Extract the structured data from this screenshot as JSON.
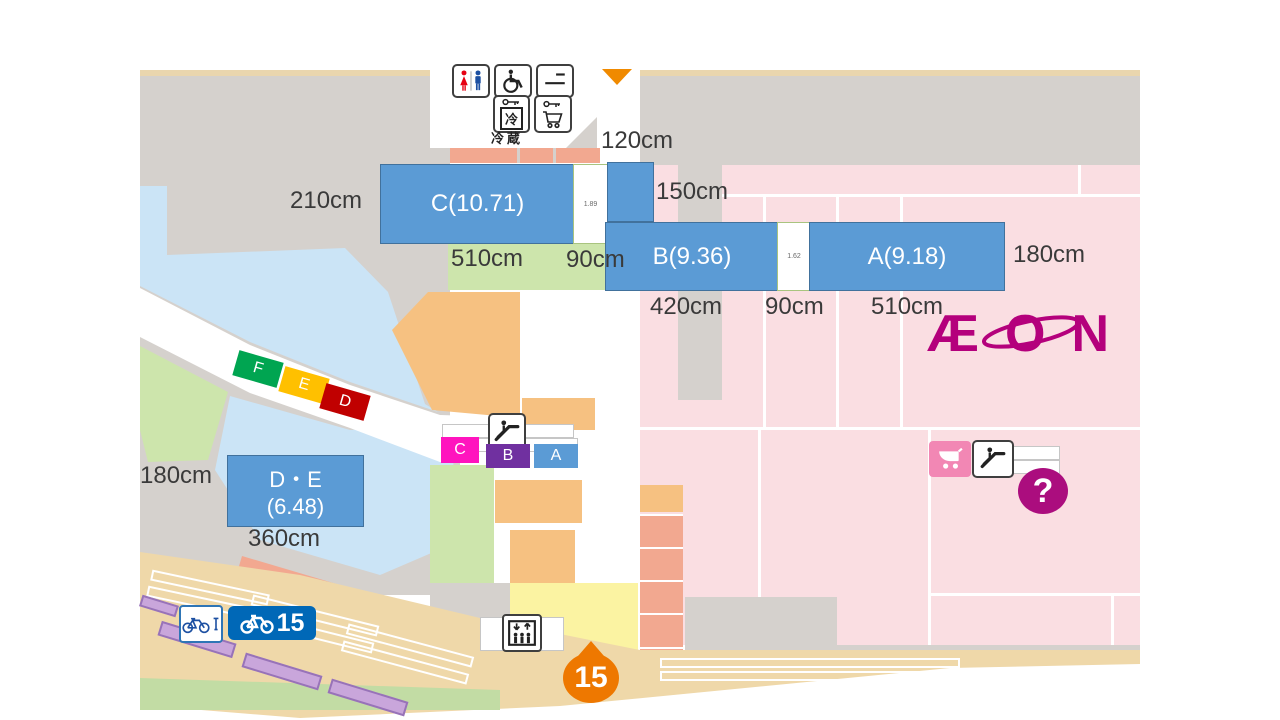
{
  "boxes": {
    "c": "C(10.71)",
    "b": "B(9.36)",
    "a": "A(9.18)",
    "de_line1": "D・E",
    "de_line2": "(6.48)",
    "gap_c": "1.89",
    "gap_ba": "1.62"
  },
  "measurements": {
    "corridor_width": "120cm",
    "c_left": "210cm",
    "small_right": "150cm",
    "c_bottom": "510cm",
    "c_gap": "90cm",
    "a_right": "180cm",
    "b_bottom": "420cm",
    "ba_gap": "90cm",
    "a_bottom": "510cm",
    "de_left": "180cm",
    "de_bottom": "360cm"
  },
  "markers": {
    "f": "F",
    "e": "E",
    "d": "D",
    "c": "C",
    "b": "B",
    "a": "A"
  },
  "facilities": {
    "cold_storage_label": "冷蔵",
    "cold_char": "冷"
  },
  "bicycle_parking_count": "15",
  "map_pin_number": "15",
  "info_mark": "?",
  "logo_text": "ÆON",
  "colors": {
    "annotation_blue": "#5B9BD5",
    "aeon_magenta": "#B4007C",
    "pin_orange": "#EE7800",
    "marker_f_green": "#00A551",
    "marker_e_yellow": "#FFC000",
    "marker_d_red": "#C00000",
    "marker_c_magenta": "#FF14BE",
    "marker_b_purple": "#7030A0"
  }
}
